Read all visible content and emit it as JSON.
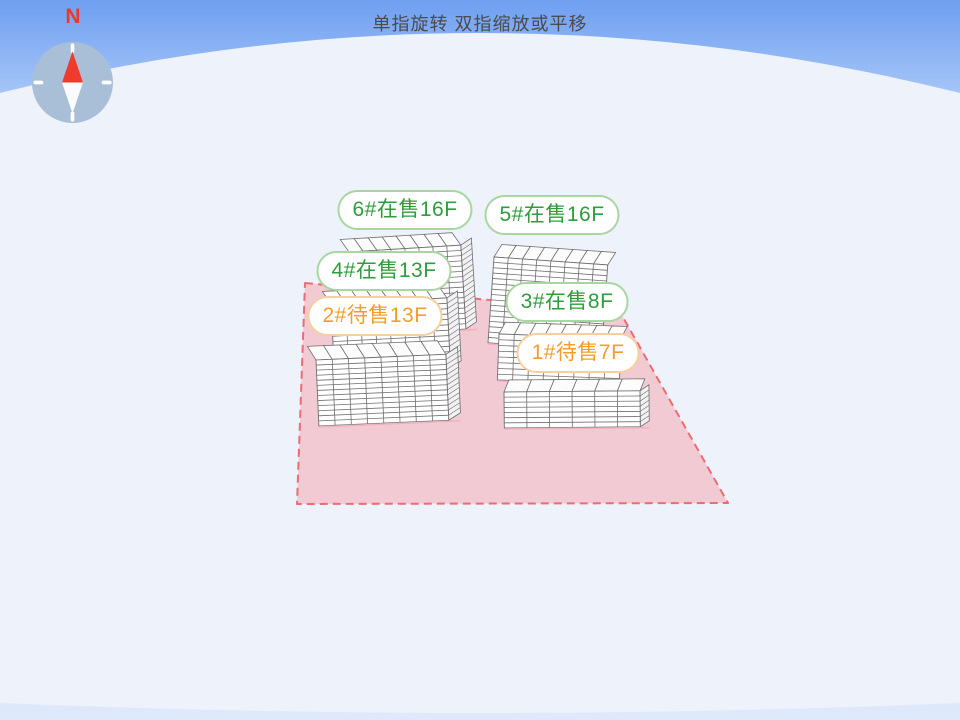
{
  "hint": {
    "text": "单指旋转 双指缩放或平移"
  },
  "compass": {
    "north_label": "N"
  },
  "parcel": {
    "fill": "#f2cad3",
    "stroke": "#ee6b72"
  },
  "palette": {
    "sky_top": "#6f9ff1",
    "sky_mid": "#a9c8f7",
    "sky_pale": "#dfe9fb",
    "ground": "#edf2fb",
    "building_face": "#ffffff",
    "building_line": "#6f6f6f",
    "building_ground_line": "#efb3bd",
    "compass_body": "#a9bfd8",
    "needle_red": "#ee3b2c",
    "needle_white": "#fbfbfd",
    "onsale_text": "#2e9d3c",
    "onsale_border": "#a9d6a0",
    "pending_text": "#f59d28",
    "pending_border": "#f7cf9e",
    "hint_text_color": "#4b4b4b",
    "north_color": "#e8392c"
  },
  "buildings": [
    {
      "id": "6",
      "label": "6#在售16F",
      "number": "6#",
      "status": "在售",
      "floors": "16F",
      "state": "onsale"
    },
    {
      "id": "5",
      "label": "5#在售16F",
      "number": "5#",
      "status": "在售",
      "floors": "16F",
      "state": "onsale"
    },
    {
      "id": "4",
      "label": "4#在售13F",
      "number": "4#",
      "status": "在售",
      "floors": "13F",
      "state": "onsale"
    },
    {
      "id": "2",
      "label": "2#待售13F",
      "number": "2#",
      "status": "待售",
      "floors": "13F",
      "state": "pending"
    },
    {
      "id": "3",
      "label": "3#在售8F",
      "number": "3#",
      "status": "在售",
      "floors": "8F",
      "state": "onsale"
    },
    {
      "id": "1",
      "label": "1#待售7F",
      "number": "1#",
      "status": "待售",
      "floors": "7F",
      "state": "pending"
    }
  ]
}
